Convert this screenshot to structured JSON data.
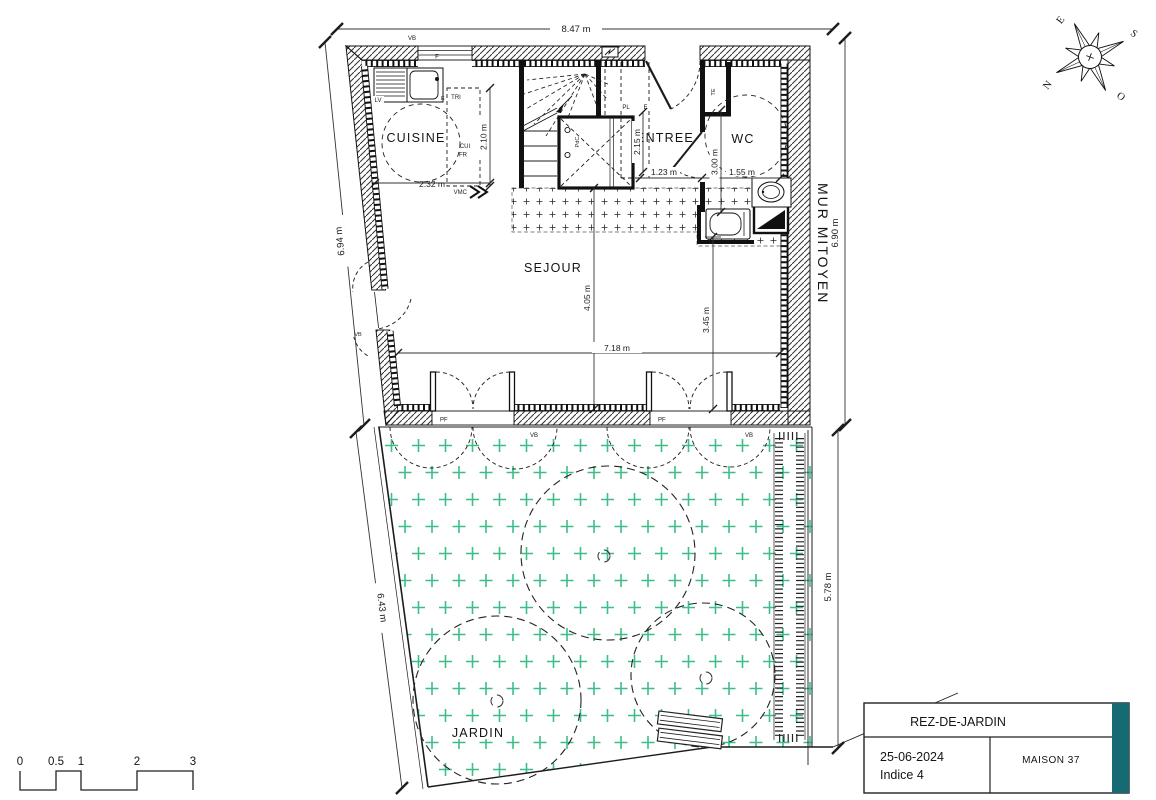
{
  "plan": {
    "rooms": {
      "cuisine": "CUISINE",
      "entree": "ENTREE",
      "wc": "WC",
      "sejour": "SEJOUR",
      "jardin": "JARDIN"
    },
    "party_wall": "MUR MITOYEN",
    "dims": {
      "overall_width": "8.47 m",
      "left_wall": "6.94 m",
      "party_wall_length": "6.90 m",
      "garden_left": "6.43 m",
      "garden_right": "5.78 m",
      "sejour_width": "7.18 m",
      "sejour_depth": "4.05 m",
      "entree_depth": "3.45 m",
      "kitchen_width": "2.32 m",
      "kitchen_depth": "2.10 m",
      "hall_width": "1.23 m",
      "wc_width": "1.55 m",
      "wc_depth": "3.00 m",
      "stair_depth": "2.15 m"
    },
    "tags": {
      "vb": "VB",
      "pf": "PF",
      "f": "F",
      "lv": "LV",
      "tri": "TRI",
      "cui": "CUI",
      "fr": "FR",
      "vmc": "VMC",
      "pl": "PL",
      "e": "E",
      "te": "TE",
      "pdc": "PdC"
    }
  },
  "compass": {
    "north": "N",
    "south": "S",
    "east": "E",
    "west": "O"
  },
  "scale_bar": {
    "ticks": [
      "0",
      "0.5",
      "1",
      "2",
      "3"
    ]
  },
  "title_block": {
    "level": "REZ-DE-JARDIN",
    "date": "25-06-2024",
    "revision": "Indice 4",
    "project": "MAISON 37"
  },
  "colors": {
    "ink": "#1c1c1c",
    "garden_green": "#3dbd87",
    "accent_teal": "#156a74"
  }
}
